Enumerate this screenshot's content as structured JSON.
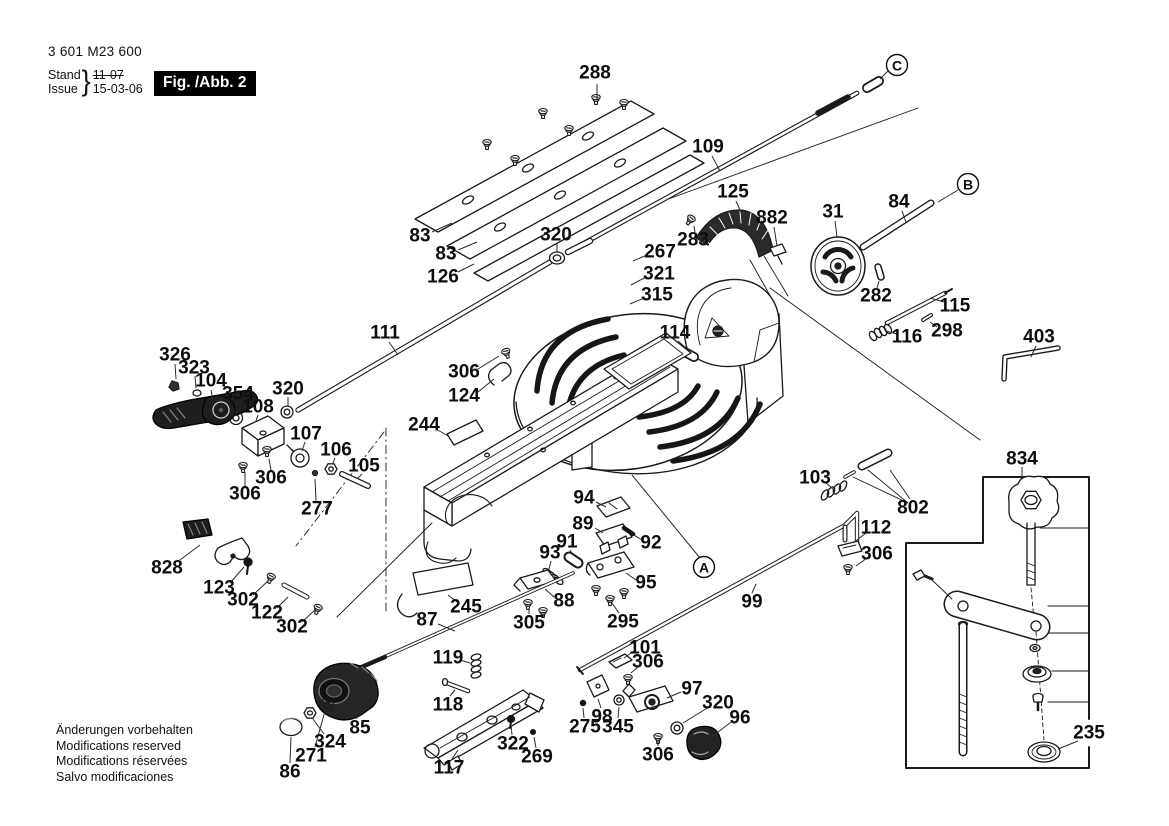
{
  "doc": {
    "part_number": "3 601 M23 600",
    "revision": {
      "stand_label": "Stand",
      "issue_label": "Issue",
      "brace": "}",
      "stand_value": "11-07",
      "stand_struck": true,
      "issue_value": "15-03-06"
    },
    "figure_label": "Fig. /Abb. 2",
    "footer_lines": [
      "Änderungen vorbehalten",
      "Modifications reserved",
      "Modifications réservées",
      "Salvo modificaciones"
    ]
  },
  "diagram": {
    "width": 1169,
    "height": 826,
    "colors": {
      "line": "#1a1a1a",
      "dark_fill": "#232323",
      "paper": "#ffffff"
    },
    "part_labels": [
      {
        "text": "288",
        "x": 595,
        "y": 73,
        "leader": [
          597,
          84,
          597,
          99
        ]
      },
      {
        "text": "109",
        "x": 708,
        "y": 147,
        "leader": [
          712,
          156,
          720,
          171
        ]
      },
      {
        "text": "83",
        "x": 420,
        "y": 236,
        "leader": [
          432,
          232,
          452,
          223
        ]
      },
      {
        "text": "83",
        "x": 446,
        "y": 254,
        "leader": [
          458,
          250,
          477,
          242
        ]
      },
      {
        "text": "126",
        "x": 443,
        "y": 277,
        "leader": [
          458,
          272,
          474,
          264
        ]
      },
      {
        "text": "320",
        "x": 556,
        "y": 235,
        "leader": [
          557,
          244,
          557,
          252
        ]
      },
      {
        "text": "267",
        "x": 660,
        "y": 252,
        "leader": [
          647,
          255,
          633,
          261
        ]
      },
      {
        "text": "321",
        "x": 659,
        "y": 274,
        "leader": [
          646,
          277,
          631,
          285
        ]
      },
      {
        "text": "315",
        "x": 657,
        "y": 295,
        "leader": [
          644,
          298,
          630,
          304
        ]
      },
      {
        "text": "114",
        "x": 675,
        "y": 333,
        "leader": [
          678,
          341,
          686,
          348
        ]
      },
      {
        "text": "111",
        "x": 385,
        "y": 333,
        "leader": [
          389,
          342,
          398,
          355
        ]
      },
      {
        "text": "306",
        "x": 464,
        "y": 372,
        "leader": [
          478,
          369,
          499,
          356
        ]
      },
      {
        "text": "124",
        "x": 464,
        "y": 396,
        "leader": [
          478,
          392,
          494,
          379
        ]
      },
      {
        "text": "326",
        "x": 175,
        "y": 355,
        "leader": [
          175,
          364,
          176,
          379
        ]
      },
      {
        "text": "323",
        "x": 194,
        "y": 368,
        "leader": [
          195,
          376,
          196,
          388
        ]
      },
      {
        "text": "104",
        "x": 211,
        "y": 381,
        "leader": [
          211,
          390,
          213,
          401
        ]
      },
      {
        "text": "354",
        "x": 238,
        "y": 394,
        "leader": [
          237,
          402,
          236,
          413
        ]
      },
      {
        "text": "108",
        "x": 258,
        "y": 407,
        "leader": [
          258,
          415,
          256,
          421
        ]
      },
      {
        "text": "320",
        "x": 288,
        "y": 389,
        "leader": [
          288,
          397,
          288,
          406
        ]
      },
      {
        "text": "107",
        "x": 306,
        "y": 434,
        "leader": [
          305,
          442,
          302,
          451
        ]
      },
      {
        "text": "106",
        "x": 336,
        "y": 450,
        "leader": [
          335,
          458,
          333,
          463
        ]
      },
      {
        "text": "105",
        "x": 364,
        "y": 466,
        "leader": [
          362,
          474,
          358,
          478
        ]
      },
      {
        "text": "306",
        "x": 271,
        "y": 478,
        "leader": [
          271,
          470,
          269,
          459
        ]
      },
      {
        "text": "306",
        "x": 245,
        "y": 494,
        "leader": [
          245,
          486,
          245,
          472
        ]
      },
      {
        "text": "277",
        "x": 317,
        "y": 509,
        "leader": [
          316,
          501,
          315,
          479
        ]
      },
      {
        "text": "244",
        "x": 424,
        "y": 425,
        "leader": [
          436,
          429,
          448,
          436
        ]
      },
      {
        "text": "94",
        "x": 584,
        "y": 498,
        "leader": [
          596,
          502,
          606,
          507
        ]
      },
      {
        "text": "89",
        "x": 583,
        "y": 524,
        "leader": [
          595,
          528,
          603,
          533
        ]
      },
      {
        "text": "92",
        "x": 651,
        "y": 543,
        "leader": [
          642,
          540,
          634,
          535
        ]
      },
      {
        "text": "91",
        "x": 567,
        "y": 542,
        "leader": [
          570,
          550,
          573,
          555
        ]
      },
      {
        "text": "93",
        "x": 550,
        "y": 553,
        "leader": [
          551,
          561,
          549,
          569
        ]
      },
      {
        "text": "95",
        "x": 646,
        "y": 583,
        "leader": [
          636,
          580,
          626,
          573
        ]
      },
      {
        "text": "88",
        "x": 564,
        "y": 601,
        "leader": [
          554,
          597,
          545,
          589
        ]
      },
      {
        "text": "245",
        "x": 466,
        "y": 607,
        "leader": [
          457,
          602,
          448,
          595
        ]
      },
      {
        "text": "87",
        "x": 427,
        "y": 620,
        "leader": [
          438,
          624,
          455,
          631
        ]
      },
      {
        "text": "305",
        "x": 529,
        "y": 623,
        "leader": [
          529,
          614,
          529,
          608
        ]
      },
      {
        "text": "295",
        "x": 623,
        "y": 622,
        "leader": [
          619,
          613,
          612,
          603
        ]
      },
      {
        "text": "119",
        "x": 448,
        "y": 658,
        "leader": [
          460,
          660,
          470,
          663
        ]
      },
      {
        "text": "118",
        "x": 448,
        "y": 705,
        "leader": [
          450,
          696,
          455,
          690
        ]
      },
      {
        "text": "101",
        "x": 645,
        "y": 648,
        "leader": [
          634,
          651,
          624,
          658
        ]
      },
      {
        "text": "306",
        "x": 648,
        "y": 662,
        "leader": [
          639,
          666,
          631,
          673
        ]
      },
      {
        "text": "97",
        "x": 692,
        "y": 689,
        "leader": [
          681,
          692,
          667,
          698
        ]
      },
      {
        "text": "320",
        "x": 718,
        "y": 703,
        "leader": [
          709,
          707,
          683,
          723
        ]
      },
      {
        "text": "96",
        "x": 740,
        "y": 718,
        "leader": [
          731,
          722,
          713,
          736
        ]
      },
      {
        "text": "98",
        "x": 602,
        "y": 717,
        "leader": [
          601,
          708,
          598,
          699
        ]
      },
      {
        "text": "275",
        "x": 585,
        "y": 727,
        "leader": [
          584,
          718,
          583,
          708
        ]
      },
      {
        "text": "345",
        "x": 618,
        "y": 727,
        "leader": [
          618,
          718,
          619,
          707
        ]
      },
      {
        "text": "306",
        "x": 658,
        "y": 755,
        "leader": [
          658,
          746,
          658,
          741
        ]
      },
      {
        "text": "322",
        "x": 513,
        "y": 744,
        "leader": [
          512,
          735,
          511,
          724
        ]
      },
      {
        "text": "269",
        "x": 537,
        "y": 757,
        "leader": [
          536,
          748,
          534,
          737
        ]
      },
      {
        "text": "117",
        "x": 449,
        "y": 768,
        "leader": [
          452,
          759,
          458,
          750
        ]
      },
      {
        "text": "86",
        "x": 290,
        "y": 772,
        "leader": [
          290,
          763,
          291,
          737
        ]
      },
      {
        "text": "271",
        "x": 311,
        "y": 756,
        "leader": [
          315,
          747,
          325,
          711
        ]
      },
      {
        "text": "324",
        "x": 330,
        "y": 742,
        "leader": [
          324,
          734,
          313,
          719
        ]
      },
      {
        "text": "85",
        "x": 360,
        "y": 728,
        "leader": [
          357,
          719,
          352,
          707
        ]
      },
      {
        "text": "302",
        "x": 243,
        "y": 600,
        "leader": [
          253,
          595,
          268,
          581
        ]
      },
      {
        "text": "123",
        "x": 219,
        "y": 588,
        "leader": [
          230,
          583,
          244,
          567
        ]
      },
      {
        "text": "122",
        "x": 267,
        "y": 613,
        "leader": [
          277,
          608,
          288,
          597
        ]
      },
      {
        "text": "302",
        "x": 292,
        "y": 627,
        "leader": [
          302,
          622,
          315,
          610
        ]
      },
      {
        "text": "828",
        "x": 167,
        "y": 568,
        "leader": [
          180,
          560,
          200,
          545
        ]
      },
      {
        "text": "99",
        "x": 752,
        "y": 602,
        "leader": [
          752,
          593,
          756,
          584
        ]
      },
      {
        "text": "103",
        "x": 815,
        "y": 478,
        "leader": [
          825,
          482,
          833,
          489
        ]
      },
      {
        "text": "802",
        "x": 913,
        "y": 508,
        "leader": [
          910,
          499,
          890,
          470
        ]
      },
      {
        "text": "112",
        "x": 876,
        "y": 528,
        "leader": [
          866,
          533,
          853,
          543
        ]
      },
      {
        "text": "306",
        "x": 877,
        "y": 554,
        "leader": [
          867,
          558,
          856,
          566
        ]
      },
      {
        "text": "834",
        "x": 1022,
        "y": 459,
        "leader": [
          1022,
          467,
          1022,
          477
        ]
      },
      {
        "text": "235",
        "x": 1089,
        "y": 733,
        "leader": [
          1078,
          741,
          1058,
          749
        ]
      },
      {
        "text": "125",
        "x": 733,
        "y": 192,
        "leader": [
          736,
          201,
          743,
          217
        ]
      },
      {
        "text": "882",
        "x": 772,
        "y": 218,
        "leader": [
          774,
          227,
          777,
          246
        ]
      },
      {
        "text": "283",
        "x": 693,
        "y": 240,
        "leader": [
          695,
          232,
          694,
          226
        ]
      },
      {
        "text": "31",
        "x": 833,
        "y": 212,
        "leader": [
          835,
          221,
          837,
          237
        ]
      },
      {
        "text": "84",
        "x": 899,
        "y": 202,
        "leader": [
          902,
          211,
          906,
          222
        ]
      },
      {
        "text": "282",
        "x": 876,
        "y": 296,
        "leader": [
          877,
          288,
          879,
          281
        ]
      },
      {
        "text": "115",
        "x": 955,
        "y": 306,
        "leader": [
          944,
          302,
          930,
          298
        ]
      },
      {
        "text": "116",
        "x": 907,
        "y": 337,
        "leader": [
          897,
          334,
          886,
          331
        ]
      },
      {
        "text": "298",
        "x": 947,
        "y": 331,
        "leader": [
          937,
          327,
          930,
          322
        ]
      },
      {
        "text": "403",
        "x": 1039,
        "y": 337,
        "leader": [
          1036,
          346,
          1031,
          357
        ]
      }
    ],
    "ref_letters": [
      {
        "text": "A",
        "x": 704,
        "y": 567,
        "leader": [
          700,
          558,
          632,
          475
        ]
      },
      {
        "text": "B",
        "x": 968,
        "y": 184,
        "leader": [
          958,
          190,
          938,
          202
        ]
      },
      {
        "text": "C",
        "x": 897,
        "y": 65,
        "leader": [
          888,
          71,
          880,
          79
        ]
      }
    ]
  }
}
